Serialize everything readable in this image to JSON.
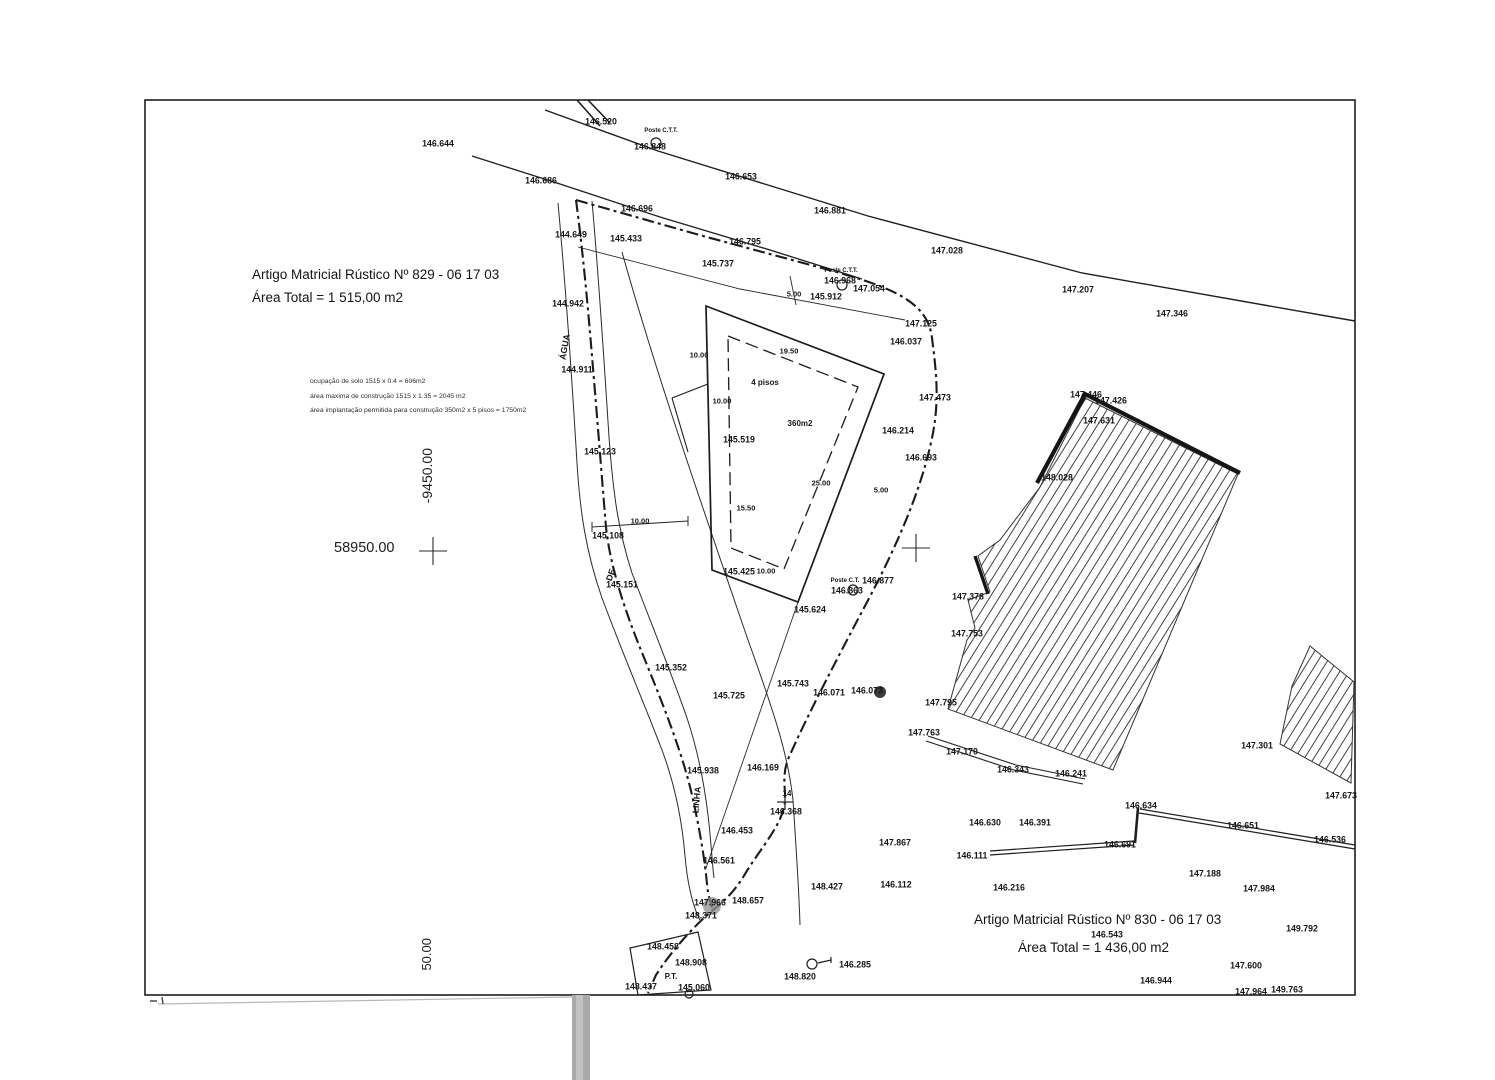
{
  "plots": {
    "plot829": {
      "article": "Artigo Matricial Rústico Nº 829 - 06 17 03",
      "area": "Área Total = 1 515,00 m2"
    },
    "plot830": {
      "article": "Artigo Matricial Rústico Nº 830 - 06 17 03",
      "area": "Área Total = 1 436,00 m2"
    }
  },
  "notes": [
    "ocupação de solo 1515 x 0.4 = 606m2",
    "área maxima de construção 1515 x 1.35 = 2045 m2",
    "área implantação permitida para construção 350m2 x 5 pisos = 1750m2"
  ],
  "grid": {
    "x_label": "58950.00",
    "y_label": "-9450.00",
    "partial_label": "50.00"
  },
  "colors": {
    "ink": "#1e1e1e",
    "label": "#161616",
    "artifact": "#a9a9a9"
  },
  "labels": [
    {
      "t": "146.644",
      "x": 438,
      "y": 144
    },
    {
      "t": "146.520",
      "x": 601,
      "y": 122
    },
    {
      "t": "Poste C.T.T.",
      "x": 661,
      "y": 131,
      "s": 6,
      "n": "poste-ctt-label"
    },
    {
      "t": "146.848",
      "x": 650,
      "y": 147
    },
    {
      "t": "146.686",
      "x": 541,
      "y": 181
    },
    {
      "t": "146.653",
      "x": 741,
      "y": 177
    },
    {
      "t": "146.881",
      "x": 830,
      "y": 211
    },
    {
      "t": "147.028",
      "x": 947,
      "y": 251
    },
    {
      "t": "147.207",
      "x": 1078,
      "y": 290
    },
    {
      "t": "147.346",
      "x": 1172,
      "y": 314
    },
    {
      "t": "146.696",
      "x": 637,
      "y": 209
    },
    {
      "t": "144.649",
      "x": 571,
      "y": 235
    },
    {
      "t": "145.433",
      "x": 626,
      "y": 239
    },
    {
      "t": "146.795",
      "x": 745,
      "y": 242
    },
    {
      "t": "145.737",
      "x": 718,
      "y": 264
    },
    {
      "t": "Poste C.T.T.",
      "x": 841,
      "y": 271,
      "s": 6,
      "n": "poste-ctt-label"
    },
    {
      "t": "146.968",
      "x": 840,
      "y": 281
    },
    {
      "t": "147.054",
      "x": 869,
      "y": 289
    },
    {
      "t": "145.912",
      "x": 826,
      "y": 297
    },
    {
      "t": "5.00",
      "x": 794,
      "y": 294,
      "s": 7.5,
      "n": "dimension-label"
    },
    {
      "t": "144.942",
      "x": 568,
      "y": 304
    },
    {
      "t": "147.125",
      "x": 921,
      "y": 324
    },
    {
      "t": "146.037",
      "x": 906,
      "y": 342
    },
    {
      "t": "ÁGUA",
      "x": 565,
      "y": 347,
      "r": -80,
      "n": "stream-label"
    },
    {
      "t": "144.911",
      "x": 577,
      "y": 370
    },
    {
      "t": "147.473",
      "x": 935,
      "y": 398
    },
    {
      "t": "146.214",
      "x": 898,
      "y": 431
    },
    {
      "t": "146.693",
      "x": 921,
      "y": 458
    },
    {
      "t": "145.519",
      "x": 739,
      "y": 440
    },
    {
      "t": "145.123",
      "x": 600,
      "y": 452
    },
    {
      "t": "19.50",
      "x": 789,
      "y": 351,
      "s": 7.5,
      "n": "dimension-label"
    },
    {
      "t": "10.00",
      "x": 699,
      "y": 355,
      "s": 7.5,
      "n": "dimension-label"
    },
    {
      "t": "10.00",
      "x": 722,
      "y": 401,
      "s": 7.5,
      "n": "dimension-label"
    },
    {
      "t": "4 pisos",
      "x": 765,
      "y": 383,
      "s": 8,
      "n": "building-floors-label"
    },
    {
      "t": "360m2",
      "x": 800,
      "y": 424,
      "s": 8,
      "n": "building-area-label"
    },
    {
      "t": "25.00",
      "x": 821,
      "y": 483,
      "s": 7.5,
      "n": "dimension-label"
    },
    {
      "t": "15.50",
      "x": 746,
      "y": 508,
      "s": 7.5,
      "n": "dimension-label"
    },
    {
      "t": "5.00",
      "x": 881,
      "y": 490,
      "s": 7.5,
      "n": "dimension-label"
    },
    {
      "t": "10.00",
      "x": 640,
      "y": 521,
      "s": 7.5,
      "n": "dimension-label"
    },
    {
      "t": "145.108",
      "x": 608,
      "y": 536
    },
    {
      "t": "145.151",
      "x": 622,
      "y": 585
    },
    {
      "t": "DE",
      "x": 611,
      "y": 575,
      "r": -70,
      "n": "stream-label"
    },
    {
      "t": "145.425",
      "x": 739,
      "y": 572
    },
    {
      "t": "10.00",
      "x": 766,
      "y": 571,
      "s": 7.5,
      "n": "dimension-label"
    },
    {
      "t": "Poste C.T.",
      "x": 845,
      "y": 581,
      "s": 6,
      "n": "poste-ctt-label"
    },
    {
      "t": "146.877",
      "x": 878,
      "y": 581
    },
    {
      "t": "146.863",
      "x": 847,
      "y": 591
    },
    {
      "t": "145.624",
      "x": 810,
      "y": 610
    },
    {
      "t": "147.446",
      "x": 1086,
      "y": 395
    },
    {
      "t": "147.426",
      "x": 1111,
      "y": 401
    },
    {
      "t": "147.631",
      "x": 1099,
      "y": 421
    },
    {
      "t": "148.028",
      "x": 1057,
      "y": 478
    },
    {
      "t": "147.378",
      "x": 968,
      "y": 597
    },
    {
      "t": "147.753",
      "x": 967,
      "y": 634
    },
    {
      "t": "145.352",
      "x": 671,
      "y": 668
    },
    {
      "t": "145.743",
      "x": 793,
      "y": 684
    },
    {
      "t": "145.725",
      "x": 729,
      "y": 696
    },
    {
      "t": "146.071",
      "x": 829,
      "y": 693
    },
    {
      "t": "146.073",
      "x": 867,
      "y": 691
    },
    {
      "t": "147.795",
      "x": 941,
      "y": 703
    },
    {
      "t": "147.763",
      "x": 924,
      "y": 733
    },
    {
      "t": "147.170",
      "x": 962,
      "y": 752
    },
    {
      "t": "146.343",
      "x": 1013,
      "y": 770
    },
    {
      "t": "146.241",
      "x": 1071,
      "y": 774
    },
    {
      "t": "147.301",
      "x": 1257,
      "y": 746
    },
    {
      "t": "147.673",
      "x": 1341,
      "y": 796
    },
    {
      "t": "145.938",
      "x": 703,
      "y": 771
    },
    {
      "t": "146.169",
      "x": 763,
      "y": 768
    },
    {
      "t": "LINHA",
      "x": 697,
      "y": 800,
      "r": -85,
      "n": "stream-label"
    },
    {
      "t": "14",
      "x": 787,
      "y": 794,
      "s": 8,
      "n": "point-number-label"
    },
    {
      "t": "146.368",
      "x": 786,
      "y": 812
    },
    {
      "t": "146.453",
      "x": 737,
      "y": 831
    },
    {
      "t": "146.561",
      "x": 719,
      "y": 861
    },
    {
      "t": "146.634",
      "x": 1141,
      "y": 806
    },
    {
      "t": "146.651",
      "x": 1243,
      "y": 826
    },
    {
      "t": "146.536",
      "x": 1330,
      "y": 840
    },
    {
      "t": "146.630",
      "x": 985,
      "y": 823
    },
    {
      "t": "146.391",
      "x": 1035,
      "y": 823
    },
    {
      "t": "146.691",
      "x": 1120,
      "y": 845
    },
    {
      "t": "147.867",
      "x": 895,
      "y": 843
    },
    {
      "t": "146.111",
      "x": 972,
      "y": 856
    },
    {
      "t": "147.188",
      "x": 1205,
      "y": 874
    },
    {
      "t": "147.984",
      "x": 1259,
      "y": 889
    },
    {
      "t": "148.427",
      "x": 827,
      "y": 887
    },
    {
      "t": "146.112",
      "x": 896,
      "y": 885
    },
    {
      "t": "146.216",
      "x": 1009,
      "y": 888
    },
    {
      "t": "147.966",
      "x": 710,
      "y": 903
    },
    {
      "t": "148.657",
      "x": 748,
      "y": 901
    },
    {
      "t": "148.371",
      "x": 701,
      "y": 916
    },
    {
      "t": "146.543",
      "x": 1107,
      "y": 935
    },
    {
      "t": "149.792",
      "x": 1302,
      "y": 929
    },
    {
      "t": "147.600",
      "x": 1246,
      "y": 966
    },
    {
      "t": "148.458",
      "x": 663,
      "y": 947
    },
    {
      "t": "148.908",
      "x": 691,
      "y": 963
    },
    {
      "t": "P.T.",
      "x": 671,
      "y": 977,
      "s": 8,
      "n": "pt-label"
    },
    {
      "t": "148.820",
      "x": 800,
      "y": 977
    },
    {
      "t": "146.285",
      "x": 855,
      "y": 965
    },
    {
      "t": "146.944",
      "x": 1156,
      "y": 981
    },
    {
      "t": "148.437",
      "x": 641,
      "y": 987
    },
    {
      "t": "145.060",
      "x": 694,
      "y": 988
    },
    {
      "t": "147.964",
      "x": 1251,
      "y": 992
    },
    {
      "t": "149.763",
      "x": 1287,
      "y": 990
    }
  ]
}
